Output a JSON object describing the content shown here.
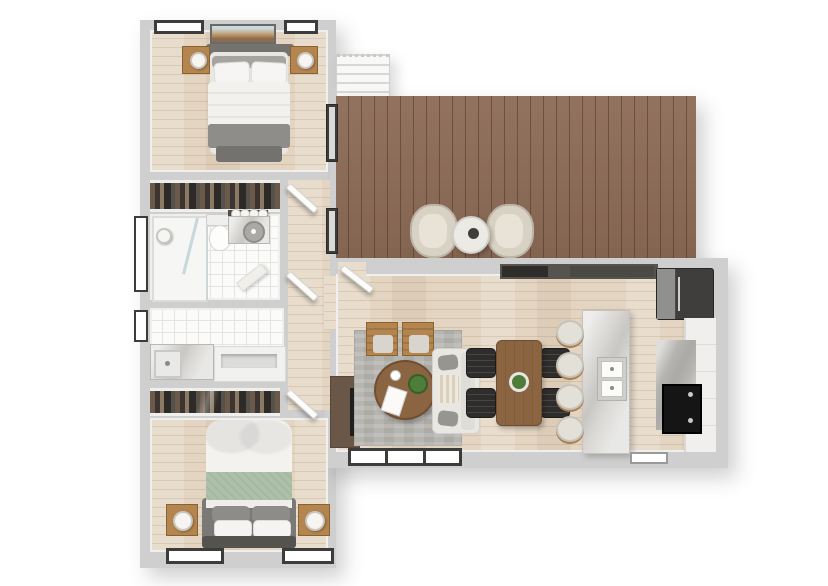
{
  "meta": {
    "type": "3d-floor-plan-render",
    "view": "top-down",
    "description": "Rendered top-view floor plan of a two-bedroom apartment with bathroom, utility room, open living/dining/kitchen area and a large wooden deck with staircase",
    "visible_text": []
  },
  "palette": {
    "wall": "#cfcfcf",
    "wallInner": "#efefee",
    "frame": "#3c3c3a",
    "floorWood": "#e3d5c1",
    "deckWood": "#8b6a55",
    "tile": "#fbfbfa",
    "grout": "#e4e4e2",
    "rug": "#b7b5b0",
    "rugDark": "#adaba6",
    "oak": "#b5854f",
    "tableWood": "#8b6441",
    "charcoal": "#332e2b",
    "sofaWhite": "#e9e7e2",
    "pillowGray": "#97958f",
    "bedGray": "#8f8d89",
    "sage": "#adc1aa",
    "cream": "#d8d2c4",
    "marble": "#d9d8d5",
    "marbleDark": "#b5b4b0",
    "applianceDark": "#3f3e3c",
    "plantGreen": "#4e7d3a"
  },
  "rooms": [
    {
      "id": "bedroom-top",
      "name": "Bedroom 1",
      "furniture": [
        "double-bed",
        "headboard",
        "nightstand-left",
        "nightstand-right",
        "table-lamp",
        "table-lamp",
        "foot-bench",
        "wall-art",
        "window",
        "window"
      ]
    },
    {
      "id": "closet-top",
      "name": "Closet",
      "furniture": [
        "hanging-clothes-rail"
      ]
    },
    {
      "id": "bathroom",
      "name": "Bathroom",
      "furniture": [
        "walk-in-shower",
        "shower-head",
        "glass-door",
        "toilet",
        "vanity-counter",
        "round-sink",
        "vanity-lights",
        "bath-mat",
        "window"
      ]
    },
    {
      "id": "utility",
      "name": "Utility Room",
      "furniture": [
        "counter-with-sink",
        "open-cabinet",
        "window"
      ]
    },
    {
      "id": "closet-bottom",
      "name": "Closet",
      "furniture": [
        "sliding-door-wardrobe"
      ]
    },
    {
      "id": "bedroom-bottom",
      "name": "Bedroom 2",
      "furniture": [
        "double-bed",
        "sage-throw-blanket",
        "headboard",
        "nightstand-left",
        "nightstand-right",
        "table-lamp",
        "table-lamp",
        "window",
        "window"
      ]
    },
    {
      "id": "hallway",
      "name": "Hallway",
      "furniture": [
        "door-to-bedroom-1",
        "door-to-bathroom",
        "door-to-bedroom-2"
      ]
    },
    {
      "id": "living-room",
      "name": "Living Room",
      "furniture": [
        "tv-console",
        "tv",
        "herringbone-rug",
        "armchair",
        "armchair",
        "round-coffee-table",
        "potted-plant",
        "coffee-cup",
        "magazine",
        "sofa",
        "triple-window"
      ]
    },
    {
      "id": "dining-area",
      "name": "Dining Area",
      "furniture": [
        "dining-table",
        "centerpiece-plant",
        "chair",
        "chair",
        "chair",
        "chair"
      ]
    },
    {
      "id": "kitchen",
      "name": "Kitchen",
      "furniture": [
        "island-with-double-sink",
        "bar-stool",
        "bar-stool",
        "bar-stool",
        "bar-stool",
        "wall-counter",
        "refrigerator",
        "range-cooktop",
        "side-counter",
        "window"
      ]
    },
    {
      "id": "deck",
      "name": "Deck / Terrace",
      "furniture": [
        "lounge-chair",
        "lounge-chair",
        "round-side-table",
        "staircase",
        "deck-door"
      ]
    }
  ]
}
